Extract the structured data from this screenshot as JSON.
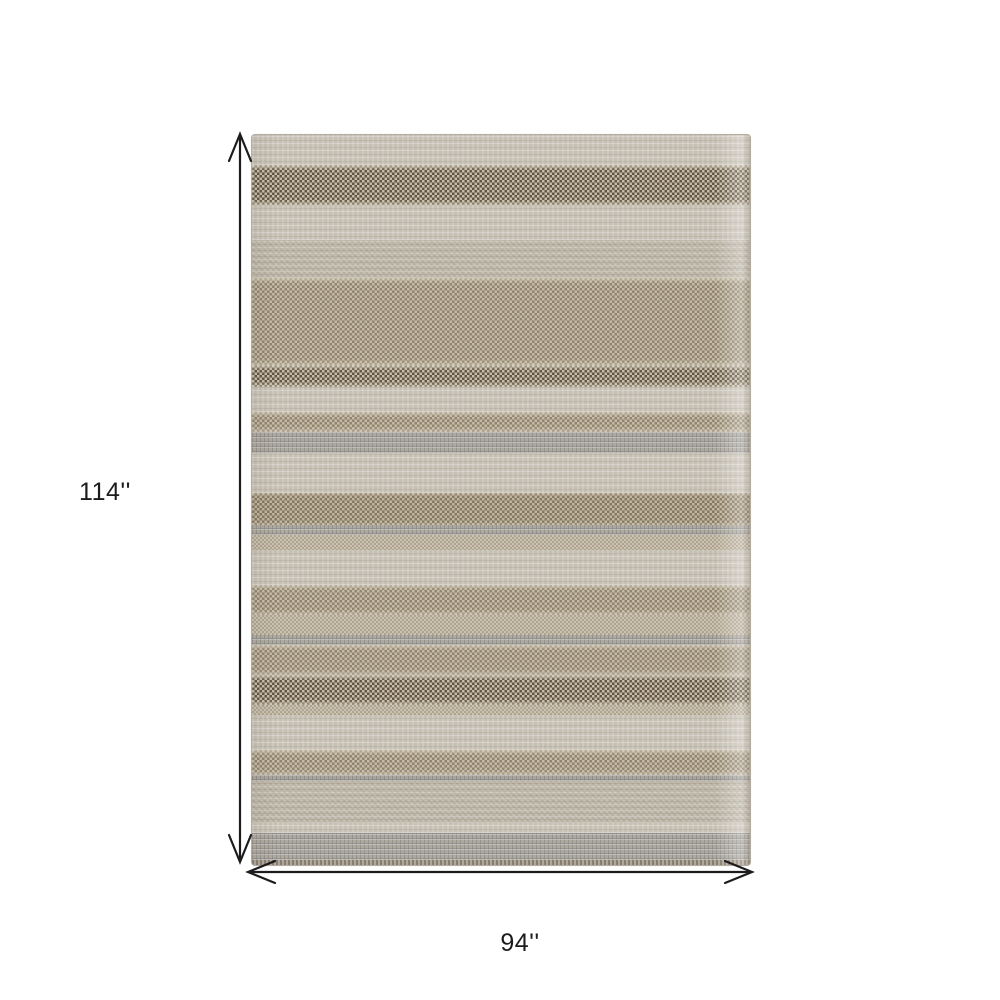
{
  "page": {
    "background_color": "#ffffff"
  },
  "diagram": {
    "kind": "product-dimension-diagram",
    "product_description": "Beige and tan horizontally striped flat-weave area rug",
    "dimensions": {
      "height_label": "114''",
      "width_label": "94''"
    },
    "arrow_color": "#1c1c1c",
    "label_color": "#1c1c1c",
    "rug": {
      "palette": {
        "light": "#cfc9bd",
        "light2": "#c2bbad",
        "dark": "#91816a",
        "medium": "#ab9e86",
        "mediumdark": "#a3947a",
        "tan": "#bfb4a0",
        "pebble": "#a49e93",
        "pebbleline": "#9e9890",
        "edge": "#9a9183"
      },
      "stripes": [
        {
          "top": 0,
          "height": 30,
          "type": "light"
        },
        {
          "top": 30,
          "height": 40,
          "type": "dark"
        },
        {
          "top": 70,
          "height": 35,
          "type": "light"
        },
        {
          "top": 105,
          "height": 38,
          "type": "light2"
        },
        {
          "top": 143,
          "height": 87,
          "type": "medium"
        },
        {
          "top": 230,
          "height": 22,
          "type": "dark"
        },
        {
          "top": 252,
          "height": 25,
          "type": "light"
        },
        {
          "top": 277,
          "height": 20,
          "type": "medium"
        },
        {
          "top": 297,
          "height": 21,
          "type": "pebble"
        },
        {
          "top": 318,
          "height": 40,
          "type": "light"
        },
        {
          "top": 358,
          "height": 32,
          "type": "mediumdark"
        },
        {
          "top": 390,
          "height": 10,
          "type": "pebble"
        },
        {
          "top": 400,
          "height": 15,
          "type": "tan"
        },
        {
          "top": 415,
          "height": 35,
          "type": "light"
        },
        {
          "top": 450,
          "height": 30,
          "type": "medium"
        },
        {
          "top": 480,
          "height": 20,
          "type": "tan"
        },
        {
          "top": 500,
          "height": 10,
          "type": "pebble"
        },
        {
          "top": 510,
          "height": 30,
          "type": "medium"
        },
        {
          "top": 540,
          "height": 30,
          "type": "dark"
        },
        {
          "top": 570,
          "height": 10,
          "type": "tan"
        },
        {
          "top": 580,
          "height": 35,
          "type": "light"
        },
        {
          "top": 615,
          "height": 25,
          "type": "medium"
        },
        {
          "top": 640,
          "height": 6,
          "type": "pebbleline"
        },
        {
          "top": 646,
          "height": 42,
          "type": "light2"
        },
        {
          "top": 688,
          "height": 10,
          "type": "light"
        },
        {
          "top": 698,
          "height": 27,
          "type": "pebble"
        },
        {
          "top": 725,
          "height": 5,
          "type": "edge"
        }
      ],
      "total_height_px": 730
    }
  }
}
